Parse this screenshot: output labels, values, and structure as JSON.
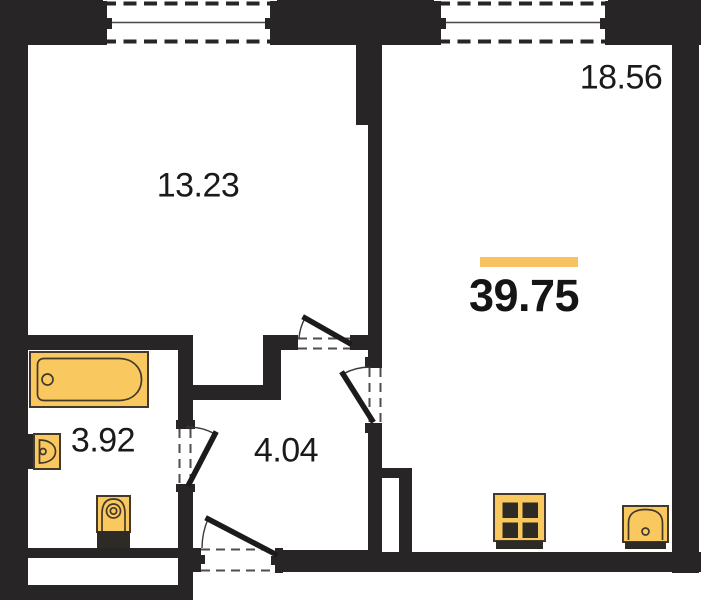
{
  "floorplan": {
    "total_area": "39.75",
    "rooms": [
      {
        "name": "room-top-left",
        "area": "13.23"
      },
      {
        "name": "room-top-right",
        "area": "18.56"
      },
      {
        "name": "bathroom",
        "area": "3.92"
      },
      {
        "name": "hallway",
        "area": "4.04"
      }
    ],
    "fixtures": [
      "bathtub-icon",
      "washbasin-icon",
      "toilet-icon",
      "stove-icon",
      "kitchen-sink-icon"
    ],
    "openings": {
      "windows": 2,
      "doors": 4
    },
    "colors": {
      "wall": "#272525",
      "fixture": "#F9C85F",
      "fixture_outline": "#43392B",
      "accent": "#F7C25F"
    }
  }
}
